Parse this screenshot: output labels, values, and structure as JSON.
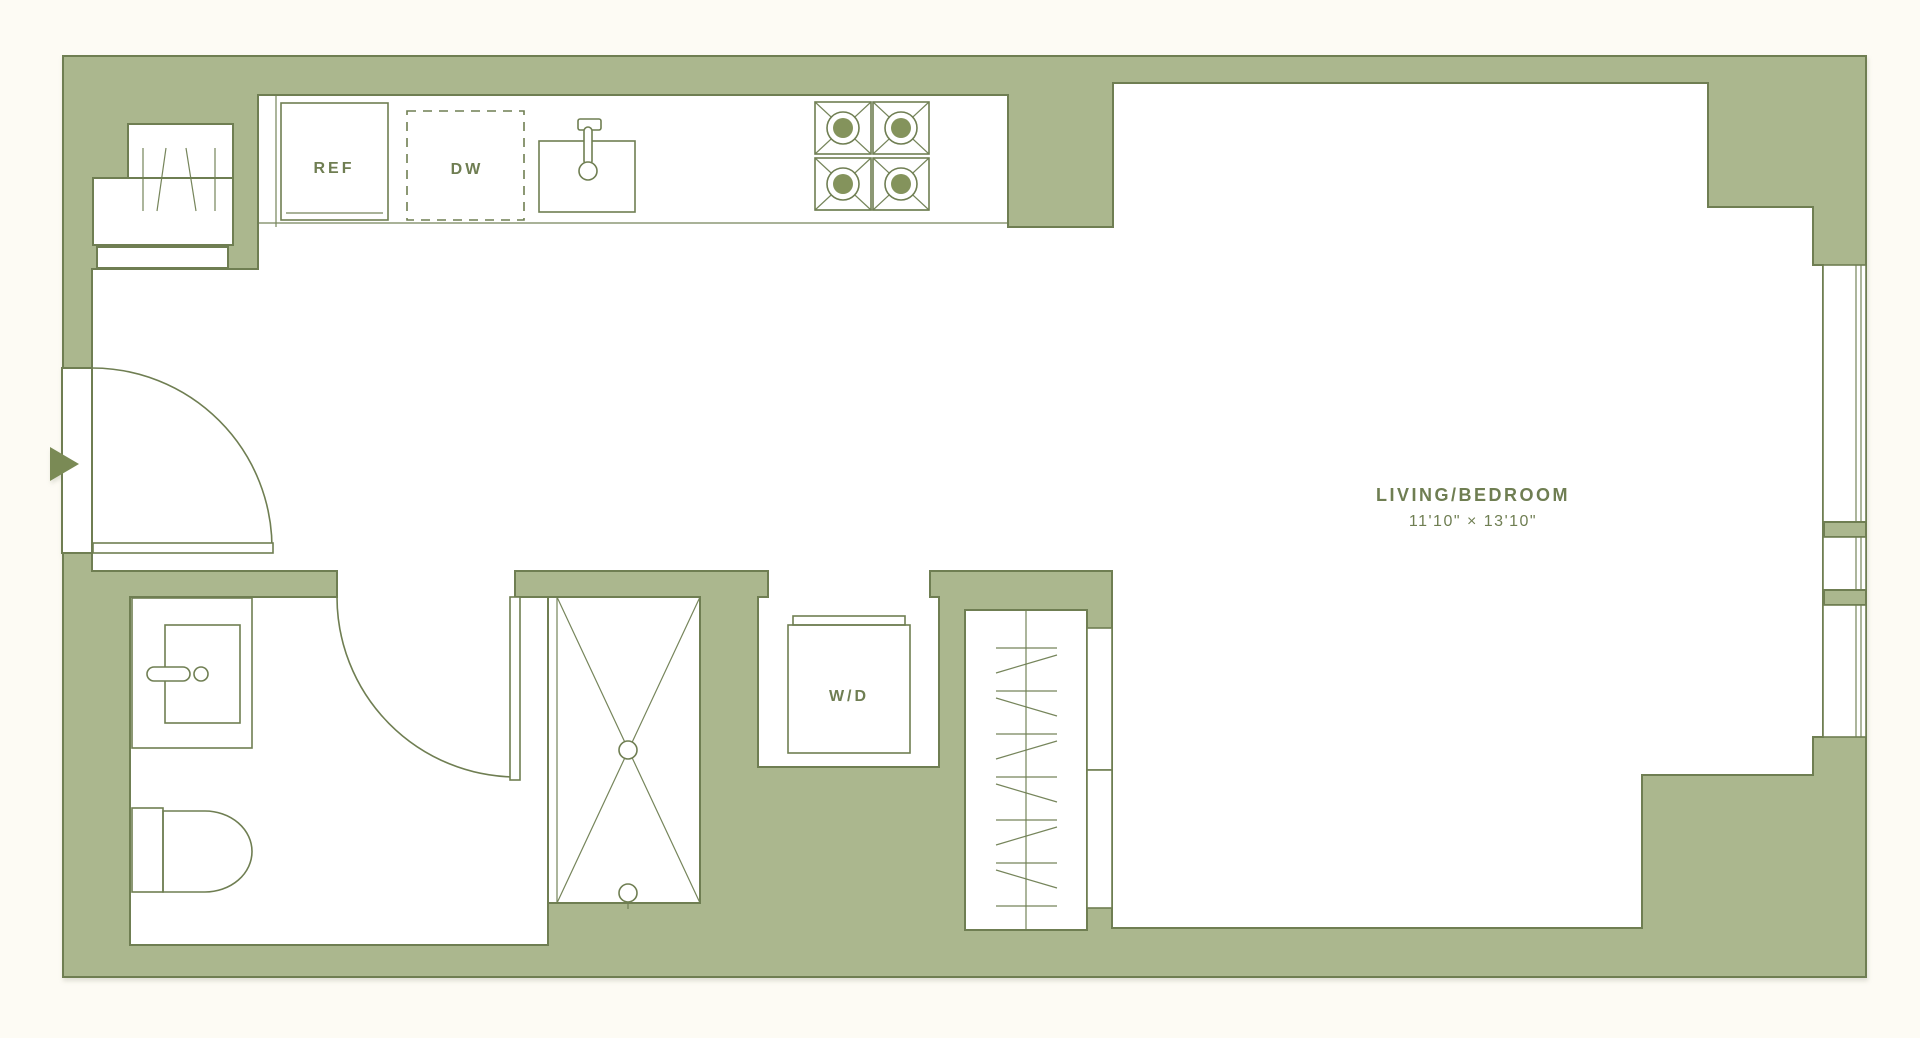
{
  "plan": {
    "title": "Studio Apartment Floor Plan",
    "rooms": {
      "living": {
        "name": "LIVING/BEDROOM",
        "dimensions": "11'10\" × 13'10\""
      },
      "kitchen": {
        "refrigerator": "REF",
        "dishwasher": "DW"
      },
      "laundry": {
        "washer_dryer": "W/D"
      }
    },
    "colors": {
      "wall_fill": "#abb78e",
      "wall_line": "#6f7e52",
      "floor": "#ffffff",
      "background": "#fdfbf4",
      "label_text": "#6f7e52",
      "entry_arrow": "#7a8a55",
      "burner": "#84935c"
    }
  }
}
